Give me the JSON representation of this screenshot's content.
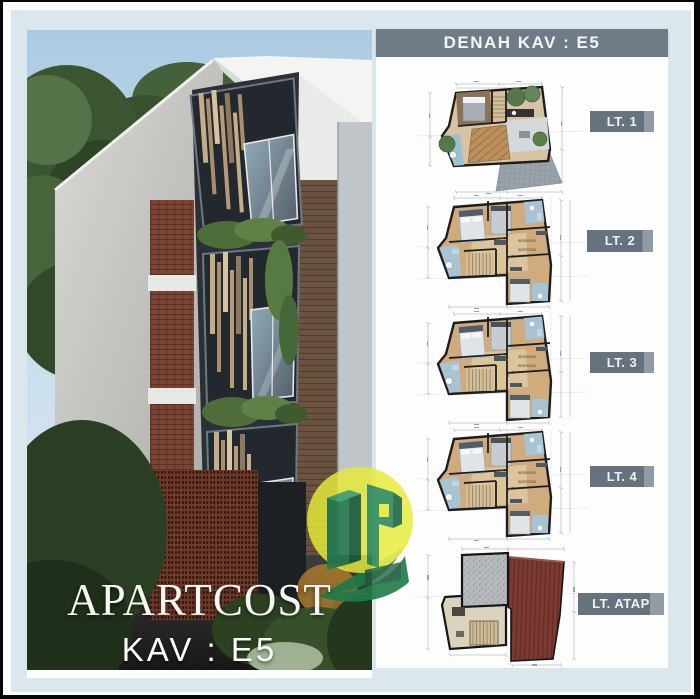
{
  "title_block": {
    "title": "APARTCOST",
    "subtitle": "KAV : E5"
  },
  "right_panel": {
    "header": "DENAH KAV : E5",
    "floors": [
      {
        "label": "LT. 1"
      },
      {
        "label": "LT. 2"
      },
      {
        "label": "LT. 3"
      },
      {
        "label": "LT. 4"
      },
      {
        "label": "LT. ATAP"
      }
    ]
  },
  "plans": {
    "typical_room_label_a": "BEDROOM",
    "typical_room_label_b": "BEDROOM"
  },
  "colors": {
    "panel_blue": "#dbe7ed",
    "header_bg": "#6f7b87",
    "label_bg": "#66727e",
    "plan_wall": "#1d1d1d",
    "wood_floor": "#cfab7e",
    "bathroom_blue": "#a7c3d4",
    "roof_red": "#7c3a31",
    "logo_yellow": "#e6ea39",
    "logo_green": "#257a50"
  }
}
